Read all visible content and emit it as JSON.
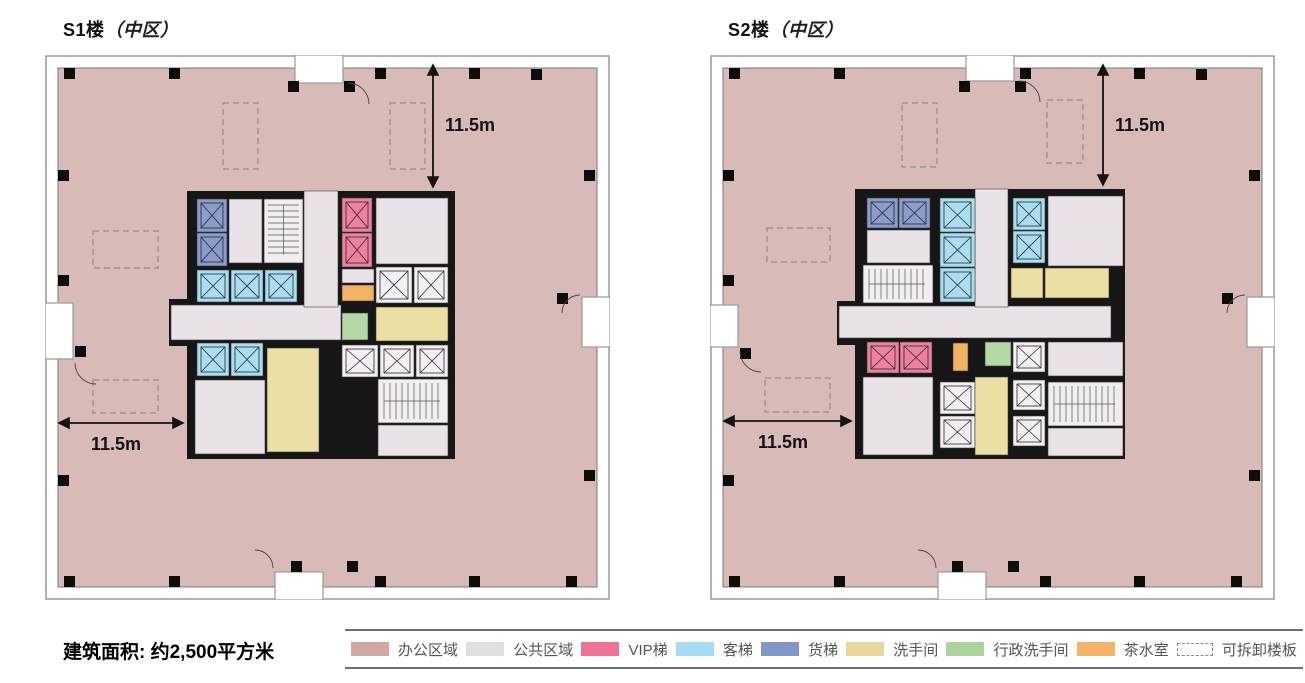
{
  "plans": [
    {
      "id": "s1",
      "title_main": "S1楼",
      "title_sub": "（中区）",
      "dim_vertical": "11.5m",
      "dim_horizontal": "11.5m"
    },
    {
      "id": "s2",
      "title_main": "S2楼",
      "title_sub": "（中区）",
      "dim_vertical": "11.5m",
      "dim_horizontal": "11.5m"
    }
  ],
  "footer": {
    "area_label": "建筑面积: 约2,500平方米"
  },
  "legend": {
    "items": [
      {
        "name": "office-area",
        "label": "办公区域",
        "color": "#d2a8a4",
        "type": "solid"
      },
      {
        "name": "public-area",
        "label": "公共区域",
        "color": "#e2dde2",
        "type": "solid"
      },
      {
        "name": "vip-elevator",
        "label": "VIP梯",
        "color": "#ee7295",
        "type": "solid"
      },
      {
        "name": "passenger-elevator",
        "label": "客梯",
        "color": "#a3dcf3",
        "type": "solid"
      },
      {
        "name": "freight-elevator",
        "label": "货梯",
        "color": "#8396cb",
        "type": "solid"
      },
      {
        "name": "restroom",
        "label": "洗手间",
        "color": "#e9d89d",
        "type": "solid"
      },
      {
        "name": "executive-restroom",
        "label": "行政洗手间",
        "color": "#abd49c",
        "type": "solid"
      },
      {
        "name": "tea-room",
        "label": "茶水室",
        "color": "#f5b369",
        "type": "solid"
      },
      {
        "name": "removable-slab",
        "label": "可拆卸楼板",
        "color": "#ffffff",
        "type": "dashed"
      }
    ]
  },
  "colors": {
    "office": "#d8bbb7",
    "public": "#e9e3e9",
    "vip": "#ef81a0",
    "passenger": "#a9ddf2",
    "freight": "#8a9bce",
    "restroom": "#ebdfa3",
    "exec": "#b5d9a6",
    "tea": "#f2b266",
    "white_elv": "#f3eff3",
    "stairs": "#f1edf1",
    "core_wall": "#161616",
    "dash_line": "#8f8f8f",
    "dim_line": "#131313"
  }
}
